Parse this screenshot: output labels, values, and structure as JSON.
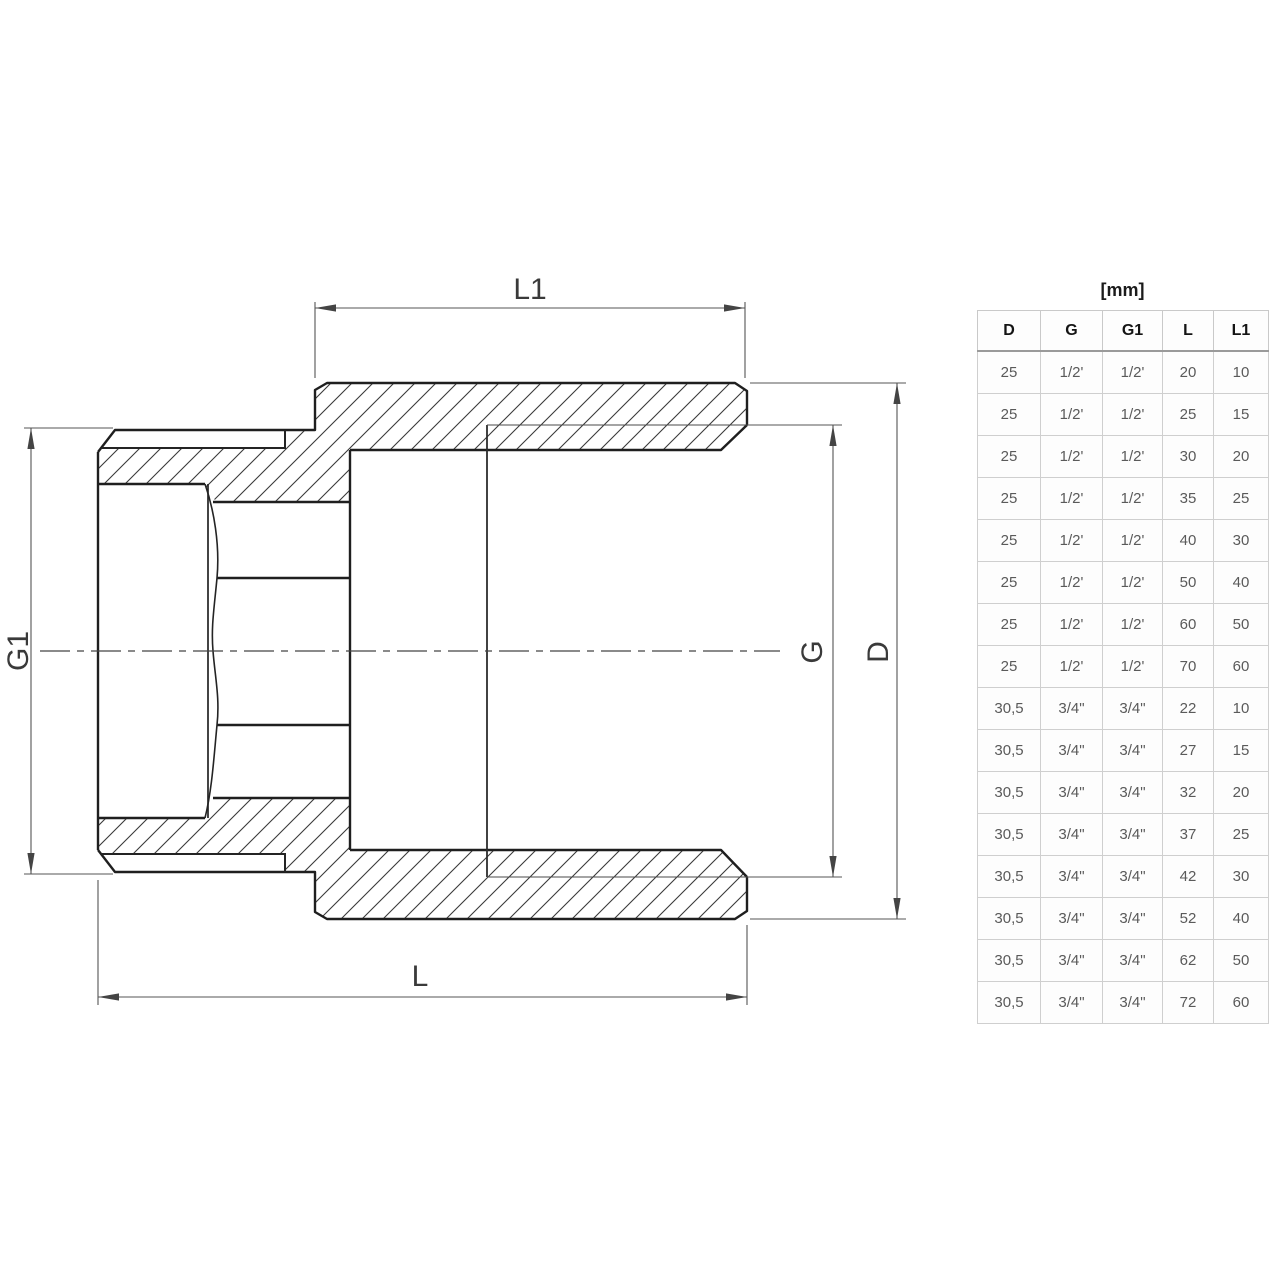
{
  "drawing": {
    "dim_labels": {
      "top": "L1",
      "bottom": "L",
      "left": "G1",
      "inner_right": "G",
      "outer_right": "D"
    }
  },
  "table": {
    "unit_label": "[mm]",
    "columns": [
      "D",
      "G",
      "G1",
      "L",
      "L1"
    ],
    "rows": [
      [
        "25",
        "1/2'",
        "1/2'",
        "20",
        "10"
      ],
      [
        "25",
        "1/2'",
        "1/2'",
        "25",
        "15"
      ],
      [
        "25",
        "1/2'",
        "1/2'",
        "30",
        "20"
      ],
      [
        "25",
        "1/2'",
        "1/2'",
        "35",
        "25"
      ],
      [
        "25",
        "1/2'",
        "1/2'",
        "40",
        "30"
      ],
      [
        "25",
        "1/2'",
        "1/2'",
        "50",
        "40"
      ],
      [
        "25",
        "1/2'",
        "1/2'",
        "60",
        "50"
      ],
      [
        "25",
        "1/2'",
        "1/2'",
        "70",
        "60"
      ],
      [
        "30,5",
        "3/4\"",
        "3/4\"",
        "22",
        "10"
      ],
      [
        "30,5",
        "3/4\"",
        "3/4\"",
        "27",
        "15"
      ],
      [
        "30,5",
        "3/4\"",
        "3/4\"",
        "32",
        "20"
      ],
      [
        "30,5",
        "3/4\"",
        "3/4\"",
        "37",
        "25"
      ],
      [
        "30,5",
        "3/4\"",
        "3/4\"",
        "42",
        "30"
      ],
      [
        "30,5",
        "3/4\"",
        "3/4\"",
        "52",
        "40"
      ],
      [
        "30,5",
        "3/4\"",
        "3/4\"",
        "62",
        "50"
      ],
      [
        "30,5",
        "3/4\"",
        "3/4\"",
        "72",
        "60"
      ]
    ]
  }
}
